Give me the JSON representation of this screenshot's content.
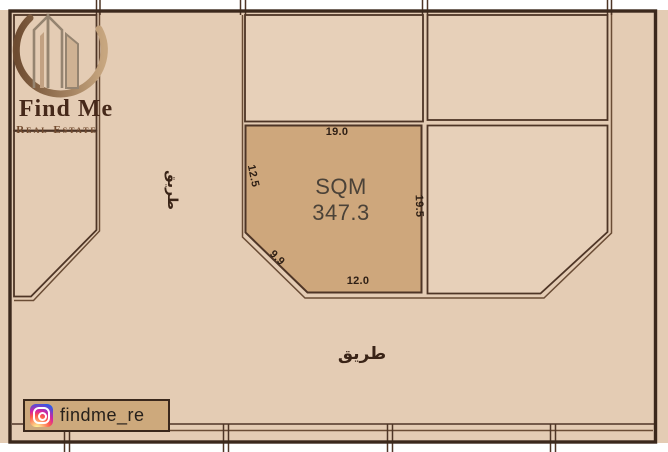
{
  "logo": {
    "title": "Find Me",
    "subtitle": "Real Estate"
  },
  "badge": {
    "handle": "findme_re",
    "icon": "instagram-icon"
  },
  "plot": {
    "area_label": "SQM",
    "area_value": "347.3",
    "dimensions": {
      "top": "19.0",
      "left": "12.5",
      "diagonal": "9.9",
      "bottom": "12.0",
      "right": "19.5"
    }
  },
  "roads": {
    "left": "طريق",
    "bottom": "طريق"
  },
  "colors": {
    "background_tan": "#e4ccb4",
    "highlight_plot": "#cea77c",
    "frame": "#3b281c",
    "plot_border": "#4e3526",
    "road_edge": "#6a4c35",
    "badge_background": "#cda97c"
  }
}
